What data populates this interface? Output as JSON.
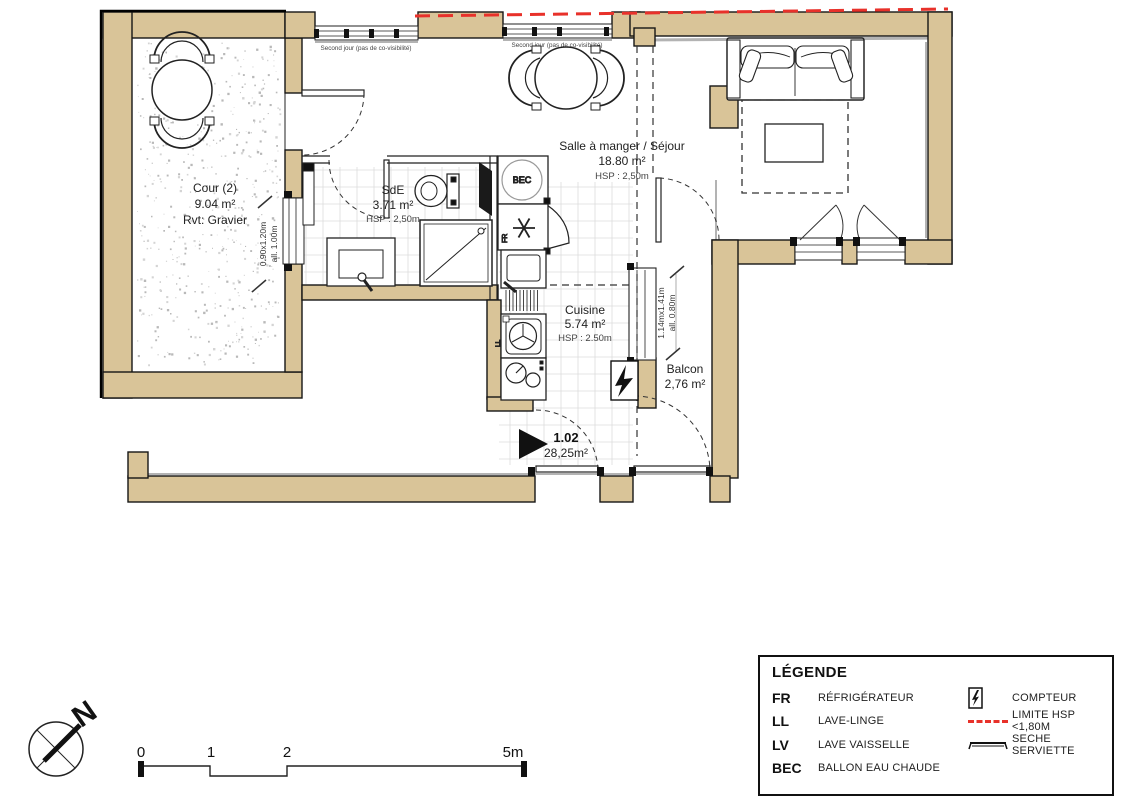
{
  "plan": {
    "rooms": [
      {
        "name": "Cour (2)",
        "area": "9.04 m²",
        "finish": "Rvt: Gravier"
      },
      {
        "name": "SdE",
        "area": "3.71 m²",
        "hsp": "HSP : 2,50m"
      },
      {
        "name": "Salle à manger / Séjour",
        "area": "18.80 m²",
        "hsp": "HSP : 2,50m"
      },
      {
        "name": "Cuisine",
        "area": "5.74 m²",
        "hsp": "HSP : 2.50m"
      },
      {
        "name": "Balcon",
        "area": "2,76 m²"
      }
    ],
    "unit": {
      "number": "1.02",
      "total_area": "28,25m²"
    },
    "notes": {
      "second_jour_1": "Second jour (pas de co-visibilité)",
      "second_jour_2": "Second jour (pas de co-visibilité)"
    },
    "dims": {
      "win_cour": {
        "size": "0.90x1.20m",
        "sill": "all. 1.00m"
      },
      "win_balcon": {
        "size": "1.14mx1.41m",
        "sill": "all. 0.80m"
      }
    },
    "tags": {
      "bec": "BEC",
      "fr": "FR",
      "ll": "LL"
    }
  },
  "legend": {
    "title": "LÉGENDE",
    "items_left": [
      {
        "abbr": "FR",
        "label": "RÉFRIGÉRATEUR"
      },
      {
        "abbr": "LL",
        "label": "LAVE-LINGE"
      },
      {
        "abbr": "LV",
        "label": "LAVE VAISSELLE"
      },
      {
        "abbr": "BEC",
        "label": "BALLON EAU CHAUDE"
      }
    ],
    "items_right": [
      {
        "icon": "compteur-icon",
        "label": "COMPTEUR"
      },
      {
        "icon": "limite-hsp-line",
        "label": "LIMITE HSP <1,80M"
      },
      {
        "icon": "seche-serviette-icon",
        "label": "SECHE SERVIETTE"
      }
    ],
    "colors": {
      "limite_hsp": "#e8312a",
      "wall_fill": "#d9c498"
    }
  },
  "scale_bar": {
    "labels": [
      "0",
      "1",
      "2",
      "5m"
    ]
  },
  "compass": {
    "north_label": "N"
  }
}
